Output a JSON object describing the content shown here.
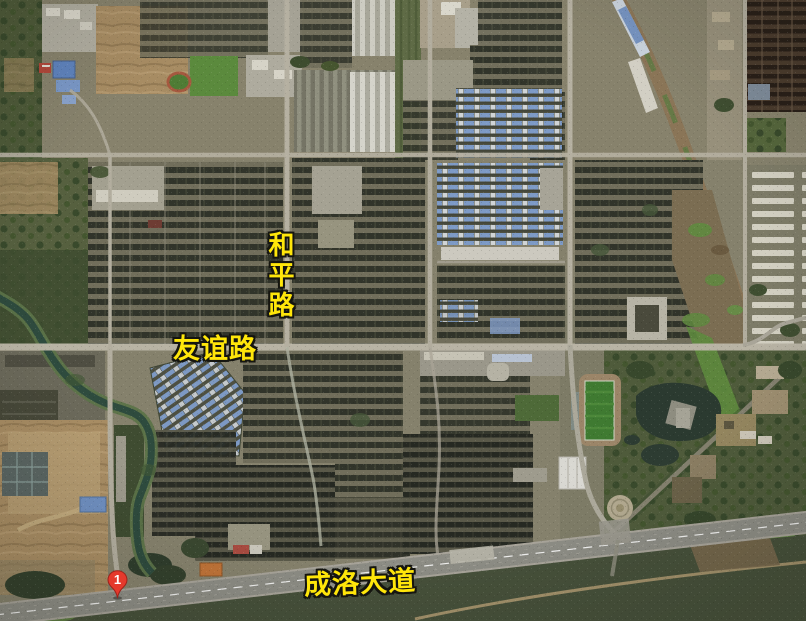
{
  "map": {
    "road_labels": [
      {
        "id": "heping",
        "text": "和平路"
      },
      {
        "id": "youyi",
        "text": "友谊路"
      },
      {
        "id": "chengluo",
        "text": "成洛大道"
      }
    ],
    "marker": {
      "number": "1"
    },
    "colors": {
      "road_label": "#ffe60a",
      "road_label_outline": "#151510",
      "marker": "#e5392c",
      "marker_border": "#9c221a"
    }
  }
}
